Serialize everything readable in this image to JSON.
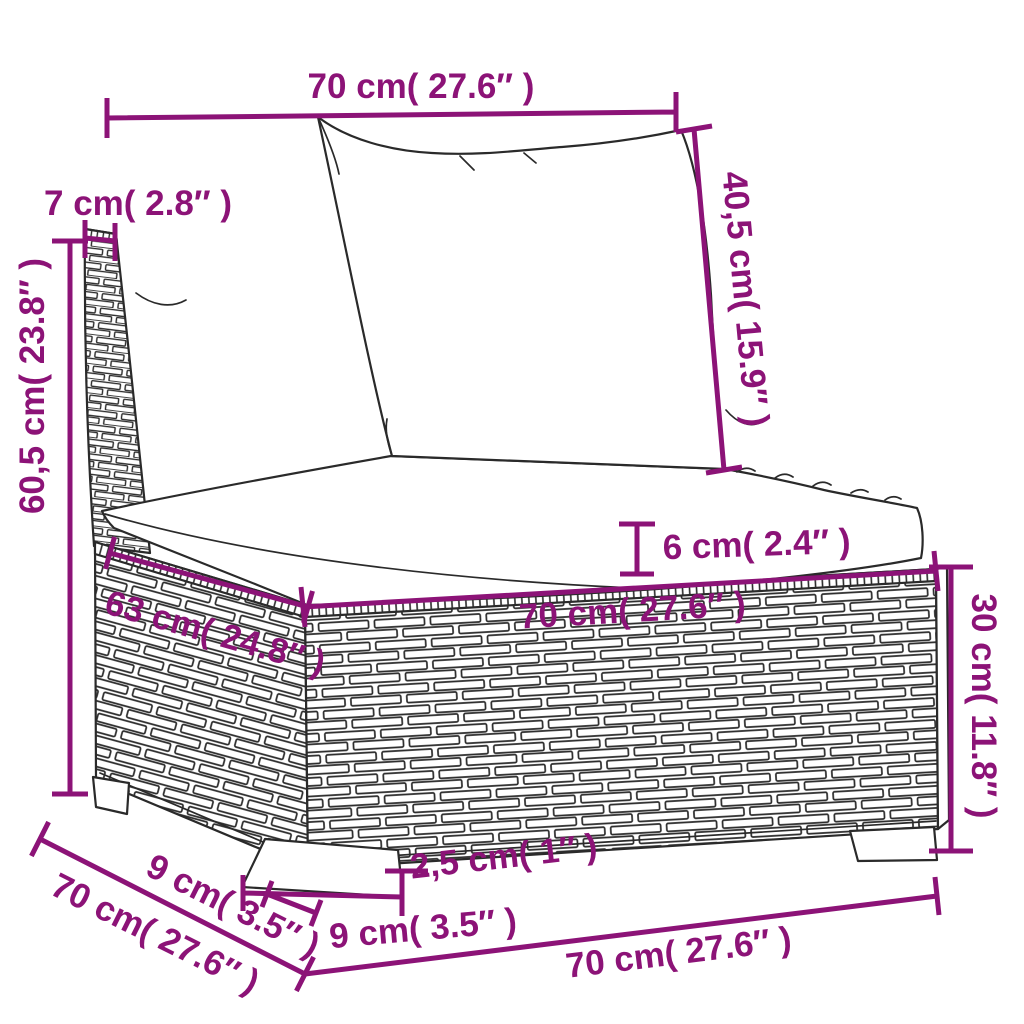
{
  "diagram": {
    "kind": "product-dimension-diagram",
    "product": "poly-rattan-sofa-section-with-cushions",
    "style": "black line-art on white with magenta dimension callouts"
  },
  "colors": {
    "accent": "#8c1377",
    "ink": "#2a2a2a",
    "bg": "#ffffff"
  },
  "dims": {
    "top_width": "70 cm( 27.6″ )",
    "back_height": "40,5 cm( 15.9″ )",
    "post_width": "7 cm( 2.8″ )",
    "total_height": "60,5 cm( 23.8″ )",
    "seat_depth": "63 cm( 24.8″ )",
    "cushion_thickness": "6 cm( 2.4″ )",
    "base_width": "70 cm( 27.6″ )",
    "base_height": "30 cm( 11.8″ )",
    "leg_height": "2,5 cm( 1″ )",
    "leg_width": "9 cm( 3.5″ )",
    "leg_depth": "9 cm( 3.5″ )",
    "base_depth": "70 cm( 27.6″ )",
    "bottom_width": "70 cm( 27.6″ )"
  }
}
